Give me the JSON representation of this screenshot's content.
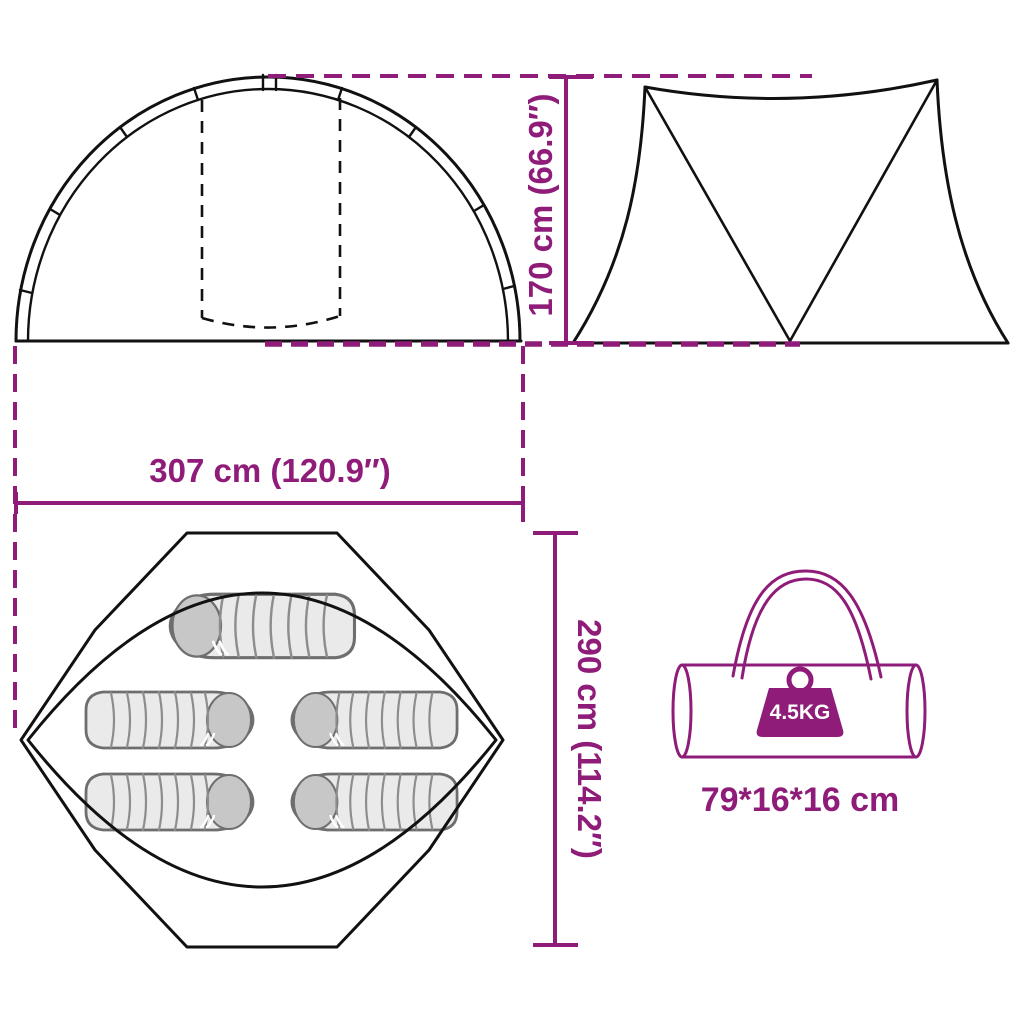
{
  "colors": {
    "accent": "#8E1C78",
    "ink": "#111111",
    "bag_fill": "#EAEAEA",
    "bag_cap": "#C7C7C7",
    "bag_outline": "#6E6E6E"
  },
  "labels": {
    "height": "170 cm (66.9″)",
    "width": "307 cm (120.9″)",
    "depth": "290 cm (114.2″)",
    "pack_size": "79*16*16 cm",
    "weight": "4.5KG"
  }
}
